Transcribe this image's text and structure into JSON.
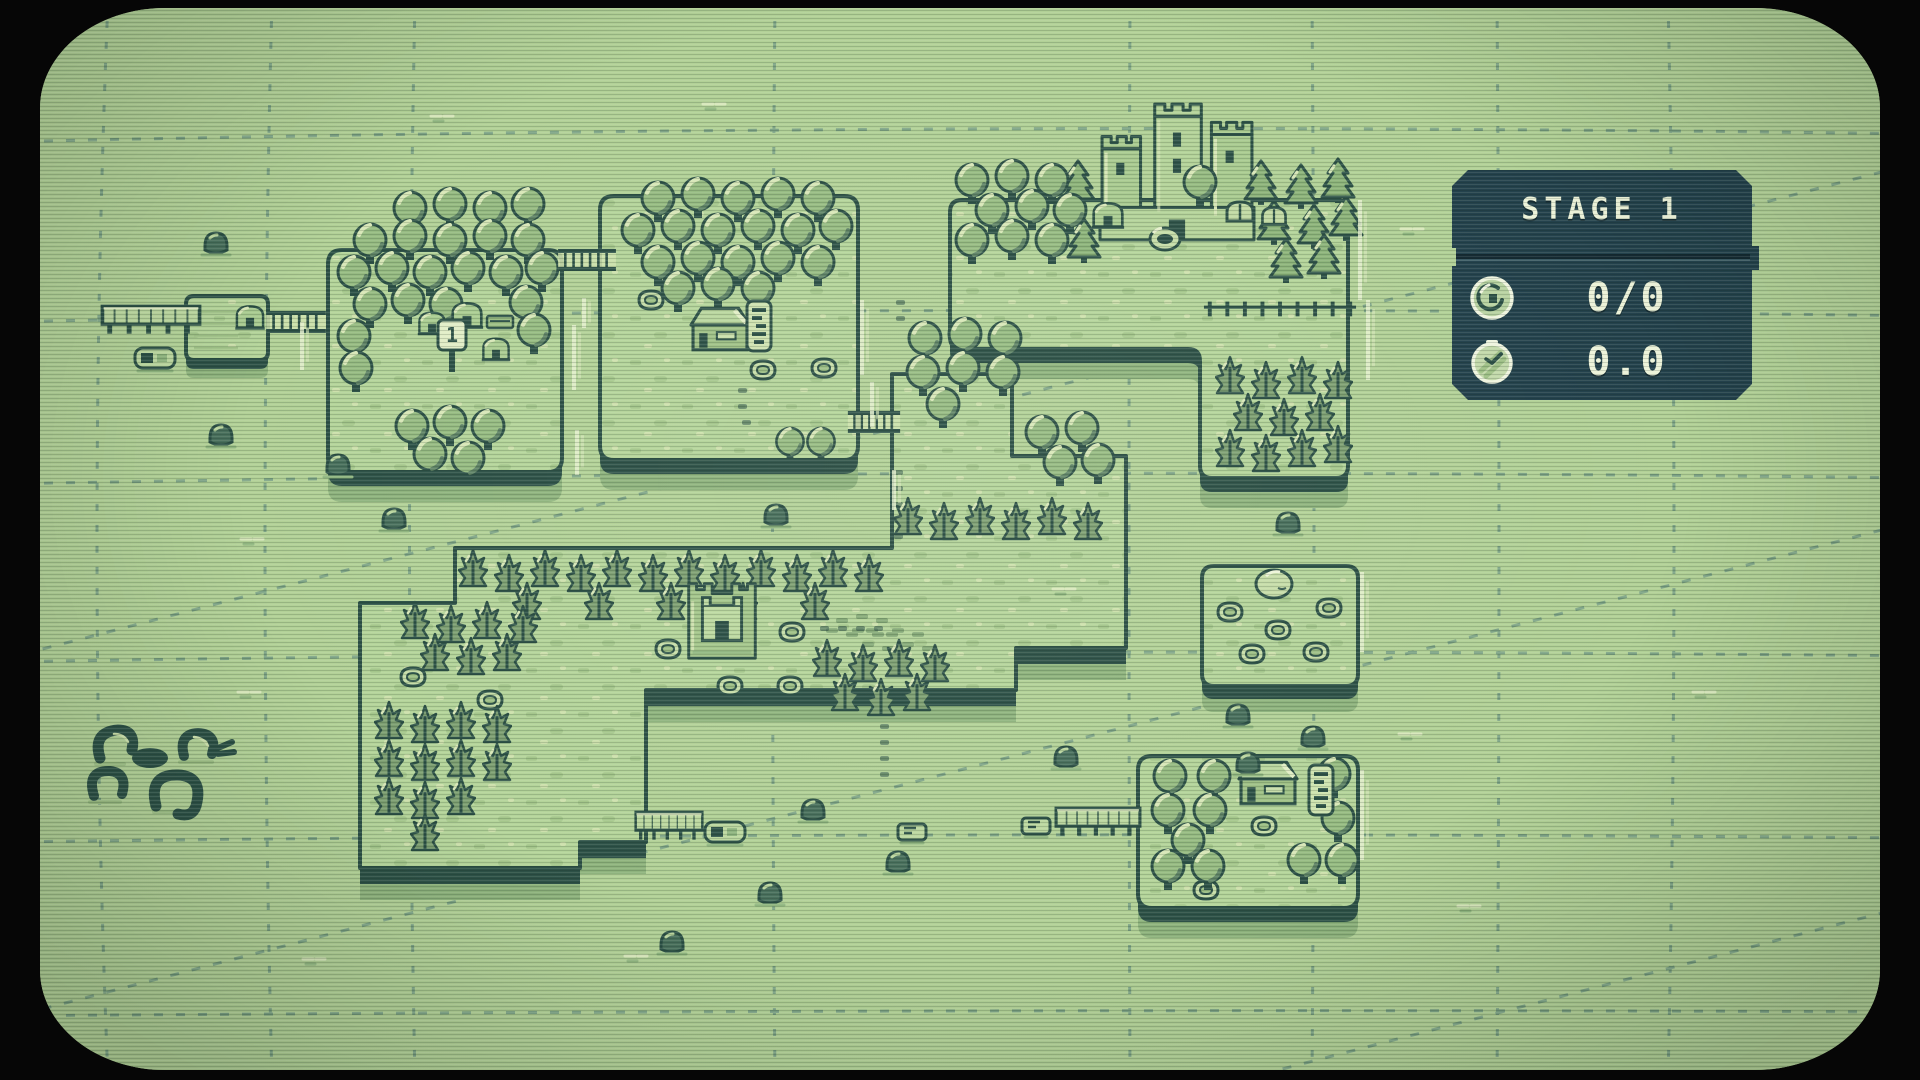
{
  "hud": {
    "title": "STAGE 1",
    "rows": [
      {
        "icon": "coin-medal-icon",
        "value": "0/0"
      },
      {
        "icon": "stopwatch-icon",
        "value": "0.0"
      }
    ]
  },
  "map": {
    "signpost_label": "1"
  },
  "colors": {
    "screen_green": "#b2d197",
    "outline_dark": "#2e5248",
    "tree_mid_green": "#96bb82",
    "highlight_green": "#d8e7b8",
    "hud_background": "#24424d",
    "hud_text": "#edf3da",
    "grid_line": "#3e6d72",
    "bezel_black": "#060606"
  }
}
